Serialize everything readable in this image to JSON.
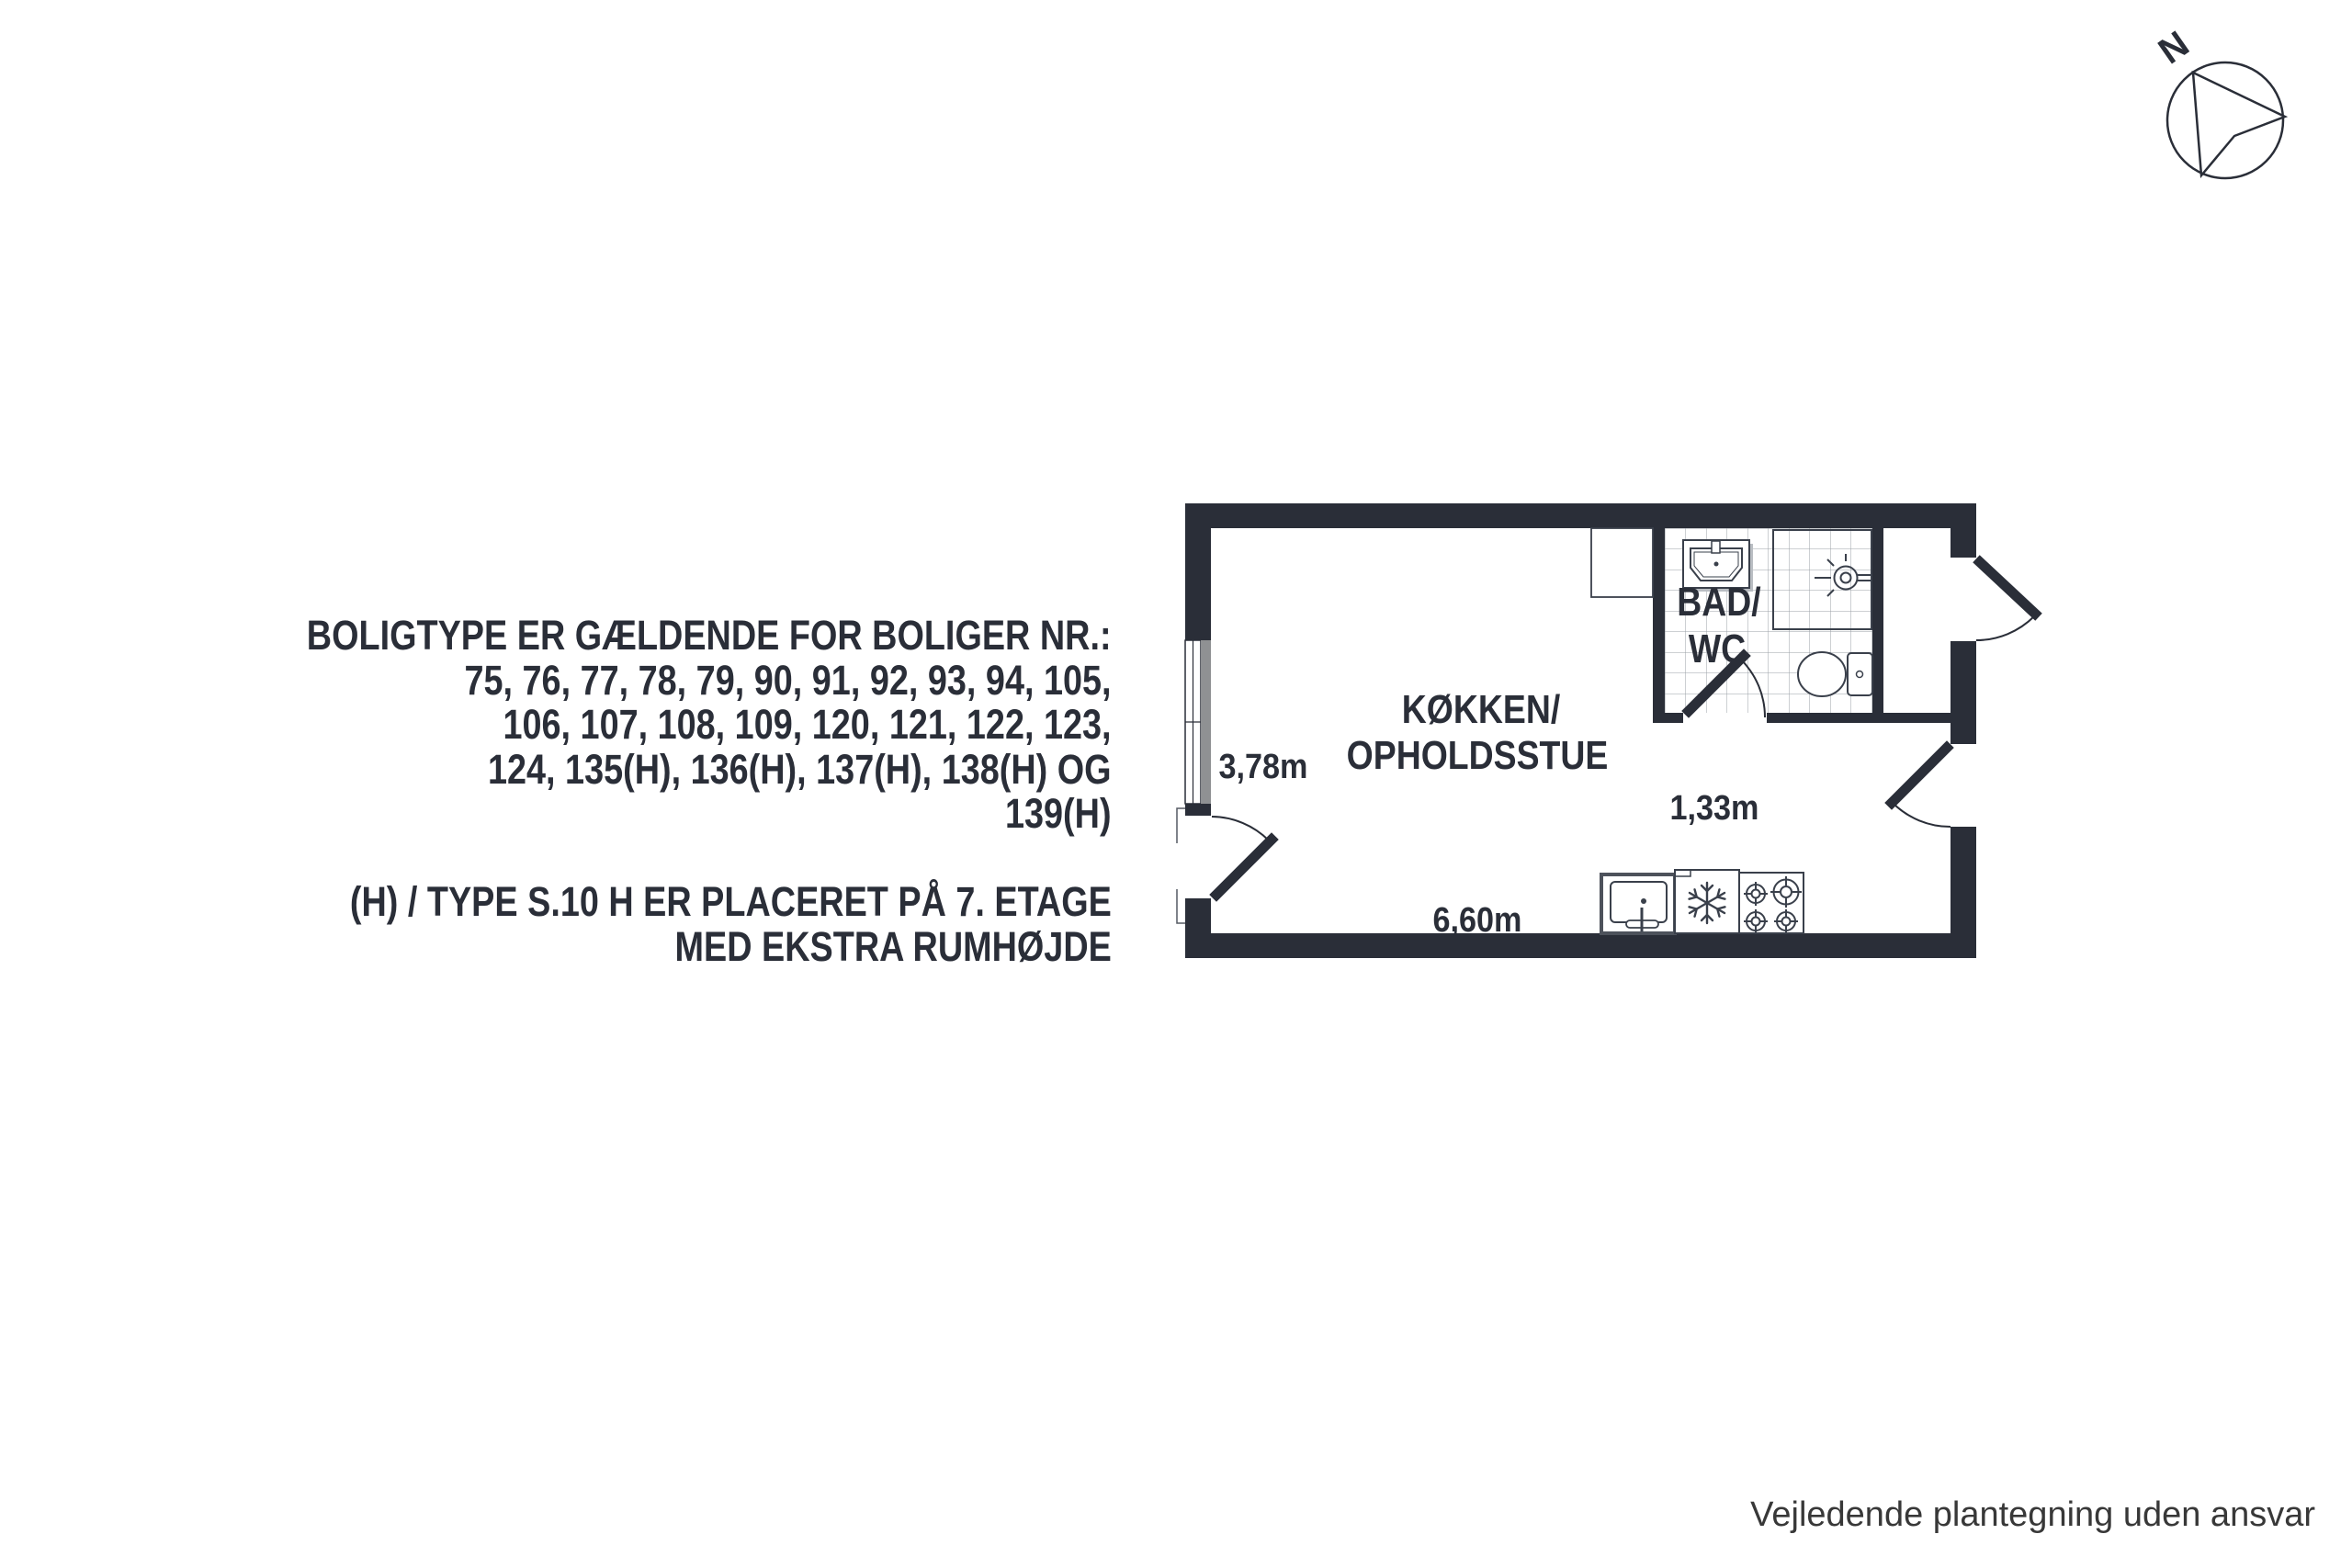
{
  "colors": {
    "ink": "#2A2E38",
    "wall": "#2A2E38",
    "window_gray": "#8F9193",
    "tile_grid": "#9BA0A7",
    "fixture": "#3A404B",
    "shadow_gray": "#B9BDC2",
    "footer_text": "#383838"
  },
  "info_block": {
    "lines": [
      "BOLIGTYPE ER GÆLDENDE FOR BOLIGER NR.:",
      "75, 76, 77, 78, 79, 90, 91, 92, 93, 94, 105,",
      "106, 107, 108, 109, 120, 121, 122, 123,",
      "124, 135(H), 136(H), 137(H), 138(H) OG",
      "139(H)"
    ],
    "note_lines": [
      "(H) / TYPE S.10 H ER PLACERET PÅ 7. ETAGE",
      "MED EKSTRA RUMHØJDE"
    ]
  },
  "floor_plan": {
    "labels": {
      "room_line1": "KØKKEN/",
      "room_line2": "OPHOLDSSTUE",
      "bath_line1": "BAD/",
      "bath_line2": "WC"
    },
    "dimensions": {
      "left_wall": "3,78m",
      "bath_width": "1,33m",
      "bottom_wall": "6,60m"
    },
    "icons": [
      "window",
      "wardrobe",
      "wash-basin-icon",
      "shower-icon",
      "toilet-icon",
      "kitchen-sink-icon",
      "fridge-icon",
      "stove-icon",
      "door-swing"
    ]
  },
  "compass": {
    "label": "N"
  },
  "footer": {
    "text": "Vejledende plantegning uden ansvar"
  }
}
